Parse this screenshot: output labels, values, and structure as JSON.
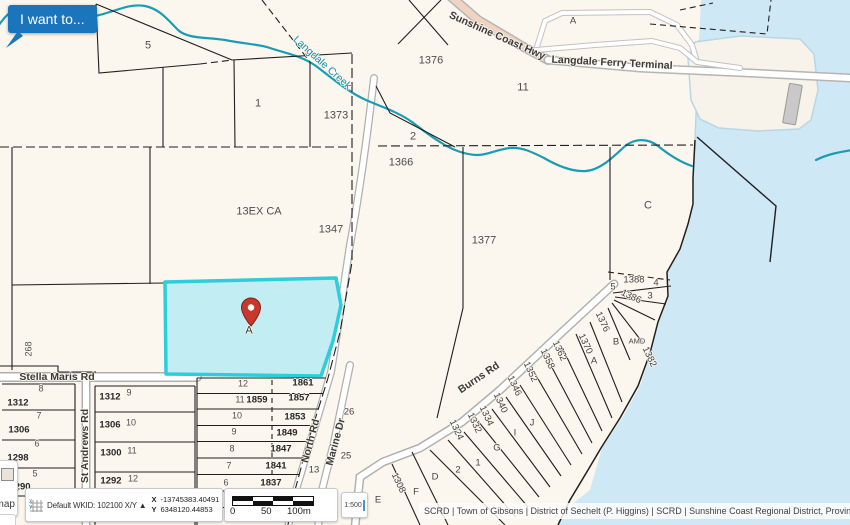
{
  "ui": {
    "i_want_to_button": "I want to...",
    "basemap_button": "Basemap",
    "coordinate_widget": {
      "srs_label": "Default WKID: 102100 X/Y ▲",
      "x_label": "X",
      "x_value": "-13745383.40491",
      "y_label": "Y",
      "y_value": "6348120.44853"
    },
    "scale_bar": {
      "start": "0",
      "mid": "50",
      "end": "100m"
    },
    "scale_input_value": "1:500",
    "attribution": "SCRD | Town of Gibsons | District of Sechelt (P. Higgins) | SCRD | Sunshine Coast Regional District, Province ..."
  },
  "colors": {
    "accent_blue": "#1b75bc",
    "land": "#fbf7ee",
    "water": "#cfe8f5",
    "creek": "#1b9cb5",
    "highlight_fill": "#c2edf2",
    "highlight_stroke": "#2ecddb",
    "pin_red": "#c9392b"
  },
  "map": {
    "marker": {
      "label": "A"
    },
    "labels": [
      {
        "t": "5",
        "x": 148,
        "y": 46,
        "c": "parcel"
      },
      {
        "t": "1",
        "x": 258,
        "y": 104,
        "c": "parcel"
      },
      {
        "t": "1373",
        "x": 336,
        "y": 116,
        "c": "parcel"
      },
      {
        "t": "1376",
        "x": 431,
        "y": 61,
        "c": "parcel"
      },
      {
        "t": "11",
        "x": 523,
        "y": 88,
        "c": "parcel"
      },
      {
        "t": "2",
        "x": 413,
        "y": 137,
        "c": "parcel"
      },
      {
        "t": "1366",
        "x": 401,
        "y": 163,
        "c": "parcel"
      },
      {
        "t": "13EX CA",
        "x": 259,
        "y": 212,
        "c": "parcel"
      },
      {
        "t": "1347",
        "x": 331,
        "y": 230,
        "c": "parcel"
      },
      {
        "t": "1377",
        "x": 484,
        "y": 241,
        "c": "parcel"
      },
      {
        "t": "C",
        "x": 648,
        "y": 206,
        "c": "parcel"
      },
      {
        "t": "A",
        "x": 573,
        "y": 21,
        "c": "parcel-sm"
      },
      {
        "t": "Sunshine Coast Hwy",
        "x": 497,
        "y": 36,
        "r": 24,
        "c": "road"
      },
      {
        "t": "Langdale Ferry Terminal",
        "x": 612,
        "y": 63,
        "r": 3,
        "c": "road"
      },
      {
        "t": "Langdale Creek",
        "x": 322,
        "y": 63,
        "r": 42,
        "c": "creek-lbl"
      },
      {
        "t": "1388",
        "x": 634,
        "y": 280,
        "c": "parcel-sm"
      },
      {
        "t": "4",
        "x": 656,
        "y": 283,
        "c": "parcel-sm"
      },
      {
        "t": "5",
        "x": 613,
        "y": 287,
        "c": "parcel-sm"
      },
      {
        "t": "1386",
        "x": 631,
        "y": 297,
        "r": 25,
        "c": "parcel-sm"
      },
      {
        "t": "3",
        "x": 650,
        "y": 296,
        "c": "parcel-sm"
      },
      {
        "t": "1376",
        "x": 602,
        "y": 322,
        "r": 65,
        "c": "parcel-sm"
      },
      {
        "t": "B",
        "x": 616,
        "y": 342,
        "c": "parcel-sm"
      },
      {
        "t": "AMD",
        "x": 637,
        "y": 341,
        "c": "parcel-xs"
      },
      {
        "t": "1382",
        "x": 649,
        "y": 357,
        "r": 65,
        "c": "parcel-sm"
      },
      {
        "t": "A",
        "x": 594,
        "y": 361,
        "c": "parcel-sm"
      },
      {
        "t": "1370",
        "x": 585,
        "y": 344,
        "r": 65,
        "c": "parcel-sm"
      },
      {
        "t": "1362",
        "x": 559,
        "y": 351,
        "r": 65,
        "c": "parcel-sm"
      },
      {
        "t": "1358",
        "x": 547,
        "y": 359,
        "r": 65,
        "c": "parcel-sm"
      },
      {
        "t": "1352",
        "x": 530,
        "y": 372,
        "r": 65,
        "c": "parcel-sm"
      },
      {
        "t": "1346",
        "x": 514,
        "y": 386,
        "r": 65,
        "c": "parcel-sm"
      },
      {
        "t": "1340",
        "x": 500,
        "y": 403,
        "r": 65,
        "c": "parcel-sm"
      },
      {
        "t": "1334",
        "x": 486,
        "y": 416,
        "r": 65,
        "c": "parcel-sm"
      },
      {
        "t": "1332",
        "x": 474,
        "y": 423,
        "r": 65,
        "c": "parcel-sm"
      },
      {
        "t": "1324",
        "x": 456,
        "y": 430,
        "r": 65,
        "c": "parcel-sm"
      },
      {
        "t": "J",
        "x": 532,
        "y": 423,
        "c": "parcel-sm"
      },
      {
        "t": "I",
        "x": 515,
        "y": 433,
        "c": "parcel-sm"
      },
      {
        "t": "G",
        "x": 497,
        "y": 448,
        "c": "parcel-sm"
      },
      {
        "t": "1",
        "x": 478,
        "y": 463,
        "c": "parcel-sm"
      },
      {
        "t": "2",
        "x": 458,
        "y": 470,
        "c": "parcel-sm"
      },
      {
        "t": "D",
        "x": 435,
        "y": 477,
        "c": "parcel-sm"
      },
      {
        "t": "Burns Rd",
        "x": 479,
        "y": 378,
        "r": -34,
        "c": "road"
      },
      {
        "t": "E",
        "x": 378,
        "y": 500,
        "c": "parcel-sm"
      },
      {
        "t": "1308",
        "x": 398,
        "y": 483,
        "r": 65,
        "c": "parcel-sm"
      },
      {
        "t": "F",
        "x": 416,
        "y": 492,
        "c": "parcel-sm"
      },
      {
        "t": "North Rd",
        "x": 311,
        "y": 441,
        "r": -75,
        "c": "road"
      },
      {
        "t": "Marine Dr",
        "x": 336,
        "y": 442,
        "r": -75,
        "c": "road"
      },
      {
        "t": "26",
        "x": 349,
        "y": 412,
        "c": "parcel-sm"
      },
      {
        "t": "25",
        "x": 346,
        "y": 456,
        "c": "parcel-sm"
      },
      {
        "t": "13",
        "x": 314,
        "y": 470,
        "c": "parcel-sm"
      },
      {
        "t": "12",
        "x": 243,
        "y": 384,
        "c": "lot"
      },
      {
        "t": "1861",
        "x": 303,
        "y": 383,
        "c": "addr"
      },
      {
        "t": "11",
        "x": 240,
        "y": 400,
        "c": "lot"
      },
      {
        "t": "1859",
        "x": 257,
        "y": 400,
        "c": "addr"
      },
      {
        "t": "1857",
        "x": 299,
        "y": 398,
        "c": "addr"
      },
      {
        "t": "10",
        "x": 237,
        "y": 416,
        "c": "lot"
      },
      {
        "t": "1853",
        "x": 295,
        "y": 417,
        "c": "addr"
      },
      {
        "t": "9",
        "x": 234,
        "y": 432,
        "c": "lot"
      },
      {
        "t": "1849",
        "x": 287,
        "y": 433,
        "c": "addr"
      },
      {
        "t": "8",
        "x": 232,
        "y": 449,
        "c": "lot"
      },
      {
        "t": "1847",
        "x": 281,
        "y": 449,
        "c": "addr"
      },
      {
        "t": "7",
        "x": 229,
        "y": 466,
        "c": "lot"
      },
      {
        "t": "1841",
        "x": 276,
        "y": 466,
        "c": "addr"
      },
      {
        "t": "6",
        "x": 226,
        "y": 483,
        "c": "lot"
      },
      {
        "t": "1837",
        "x": 271,
        "y": 483,
        "c": "addr"
      },
      {
        "t": "Stella Maris Rd",
        "x": 57,
        "y": 377,
        "c": "road"
      },
      {
        "t": "St Andrews Rd",
        "x": 85,
        "y": 446,
        "r": -90,
        "c": "road"
      },
      {
        "t": "268",
        "x": 29,
        "y": 349,
        "r": -90,
        "c": "lot"
      },
      {
        "t": "1312",
        "x": 18,
        "y": 403,
        "c": "addr"
      },
      {
        "t": "8",
        "x": 41,
        "y": 389,
        "c": "lot"
      },
      {
        "t": "1306",
        "x": 19,
        "y": 430,
        "c": "addr"
      },
      {
        "t": "7",
        "x": 39,
        "y": 416,
        "c": "lot"
      },
      {
        "t": "1298",
        "x": 18,
        "y": 458,
        "c": "addr"
      },
      {
        "t": "6",
        "x": 37,
        "y": 444,
        "c": "lot"
      },
      {
        "t": "1290",
        "x": 20,
        "y": 487,
        "c": "addr"
      },
      {
        "t": "5",
        "x": 35,
        "y": 474,
        "c": "lot"
      },
      {
        "t": "1312",
        "x": 110,
        "y": 397,
        "c": "addr"
      },
      {
        "t": "9",
        "x": 129,
        "y": 393,
        "c": "lot"
      },
      {
        "t": "1306",
        "x": 110,
        "y": 425,
        "c": "addr"
      },
      {
        "t": "10",
        "x": 131,
        "y": 423,
        "c": "lot"
      },
      {
        "t": "1300",
        "x": 111,
        "y": 453,
        "c": "addr"
      },
      {
        "t": "11",
        "x": 132,
        "y": 451,
        "c": "lot"
      },
      {
        "t": "1292",
        "x": 111,
        "y": 481,
        "c": "addr"
      },
      {
        "t": "12",
        "x": 133,
        "y": 479,
        "c": "lot"
      }
    ]
  }
}
